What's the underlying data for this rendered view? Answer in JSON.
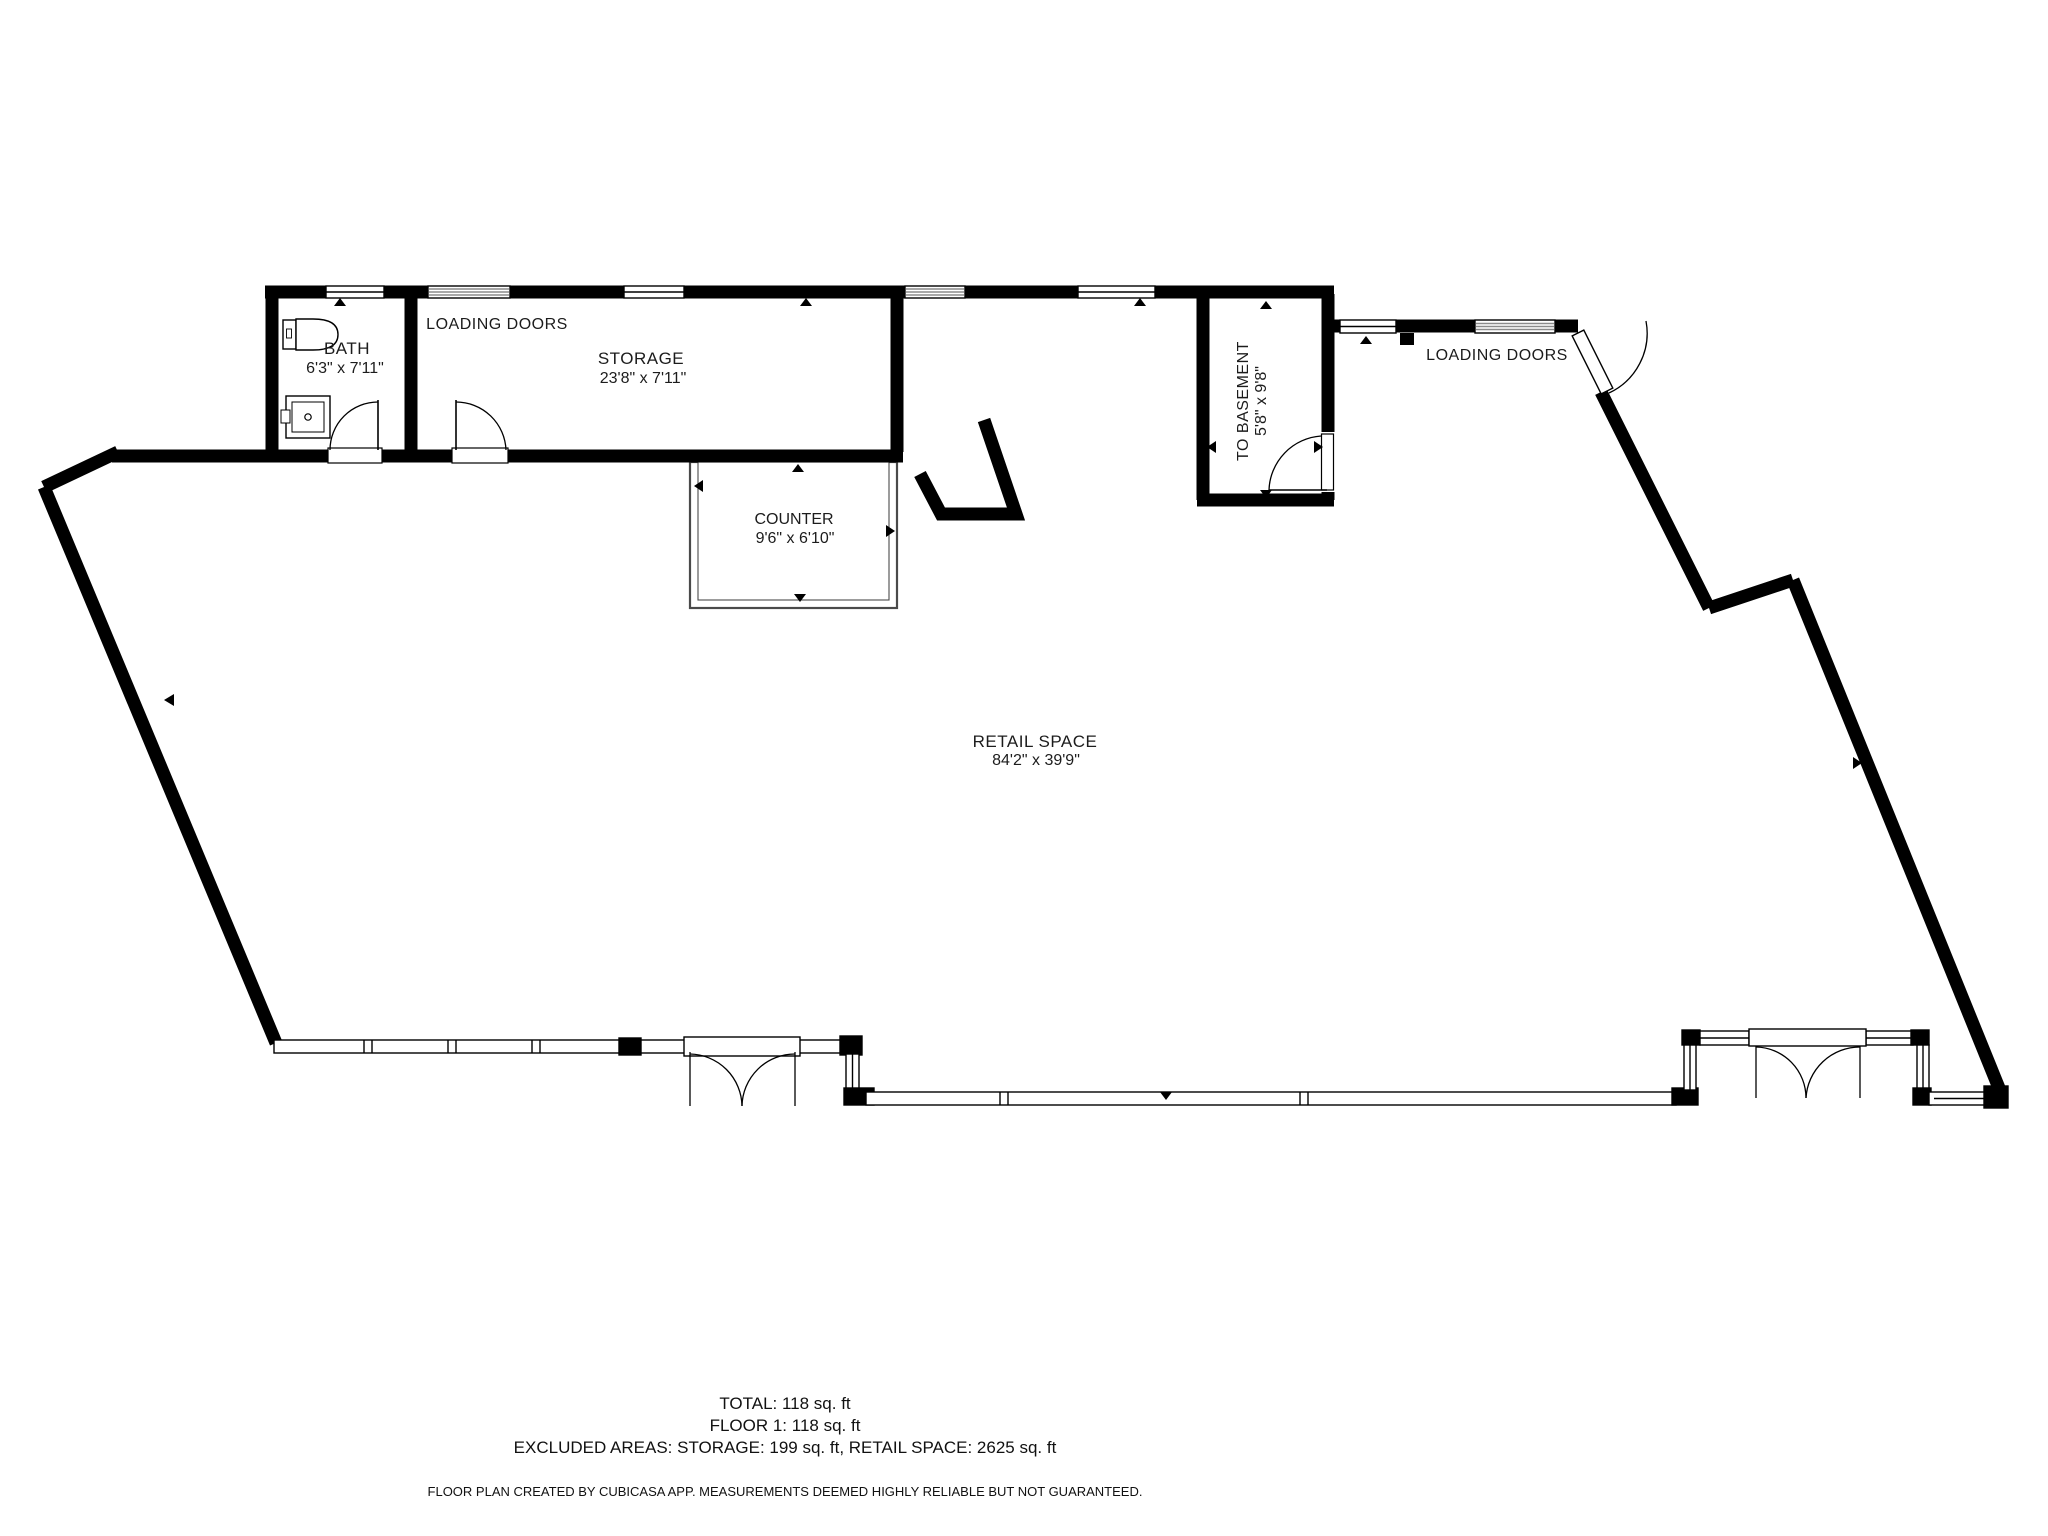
{
  "rooms": {
    "bath": {
      "name": "BATH",
      "dimensions": "6'3\" x 7'11\""
    },
    "storage": {
      "name": "STORAGE",
      "dimensions": "23'8\" x 7'11\""
    },
    "to_basement": {
      "name": "TO BASEMENT",
      "dimensions": "5'8\" x 9'8\""
    },
    "counter": {
      "name": "COUNTER",
      "dimensions": "9'6\" x 6'10\""
    },
    "retail": {
      "name": "RETAIL SPACE",
      "dimensions": "84'2\" x 39'9\""
    }
  },
  "annotations": {
    "loading_doors_left": "LOADING DOORS",
    "loading_doors_right": "LOADING DOORS"
  },
  "summary": {
    "total": "TOTAL: 118 sq. ft",
    "floor": "FLOOR 1: 118 sq. ft",
    "excluded": "EXCLUDED AREAS: STORAGE: 199 sq. ft, RETAIL SPACE: 2625 sq. ft",
    "disclaimer": "FLOOR PLAN CREATED BY CUBICASA APP. MEASUREMENTS DEEMED HIGHLY RELIABLE BUT NOT GUARANTEED."
  },
  "colors": {
    "wall": "#000000",
    "background": "#ffffff",
    "window_stripe": "#8b8b8b",
    "text": "#1c1c1c"
  }
}
